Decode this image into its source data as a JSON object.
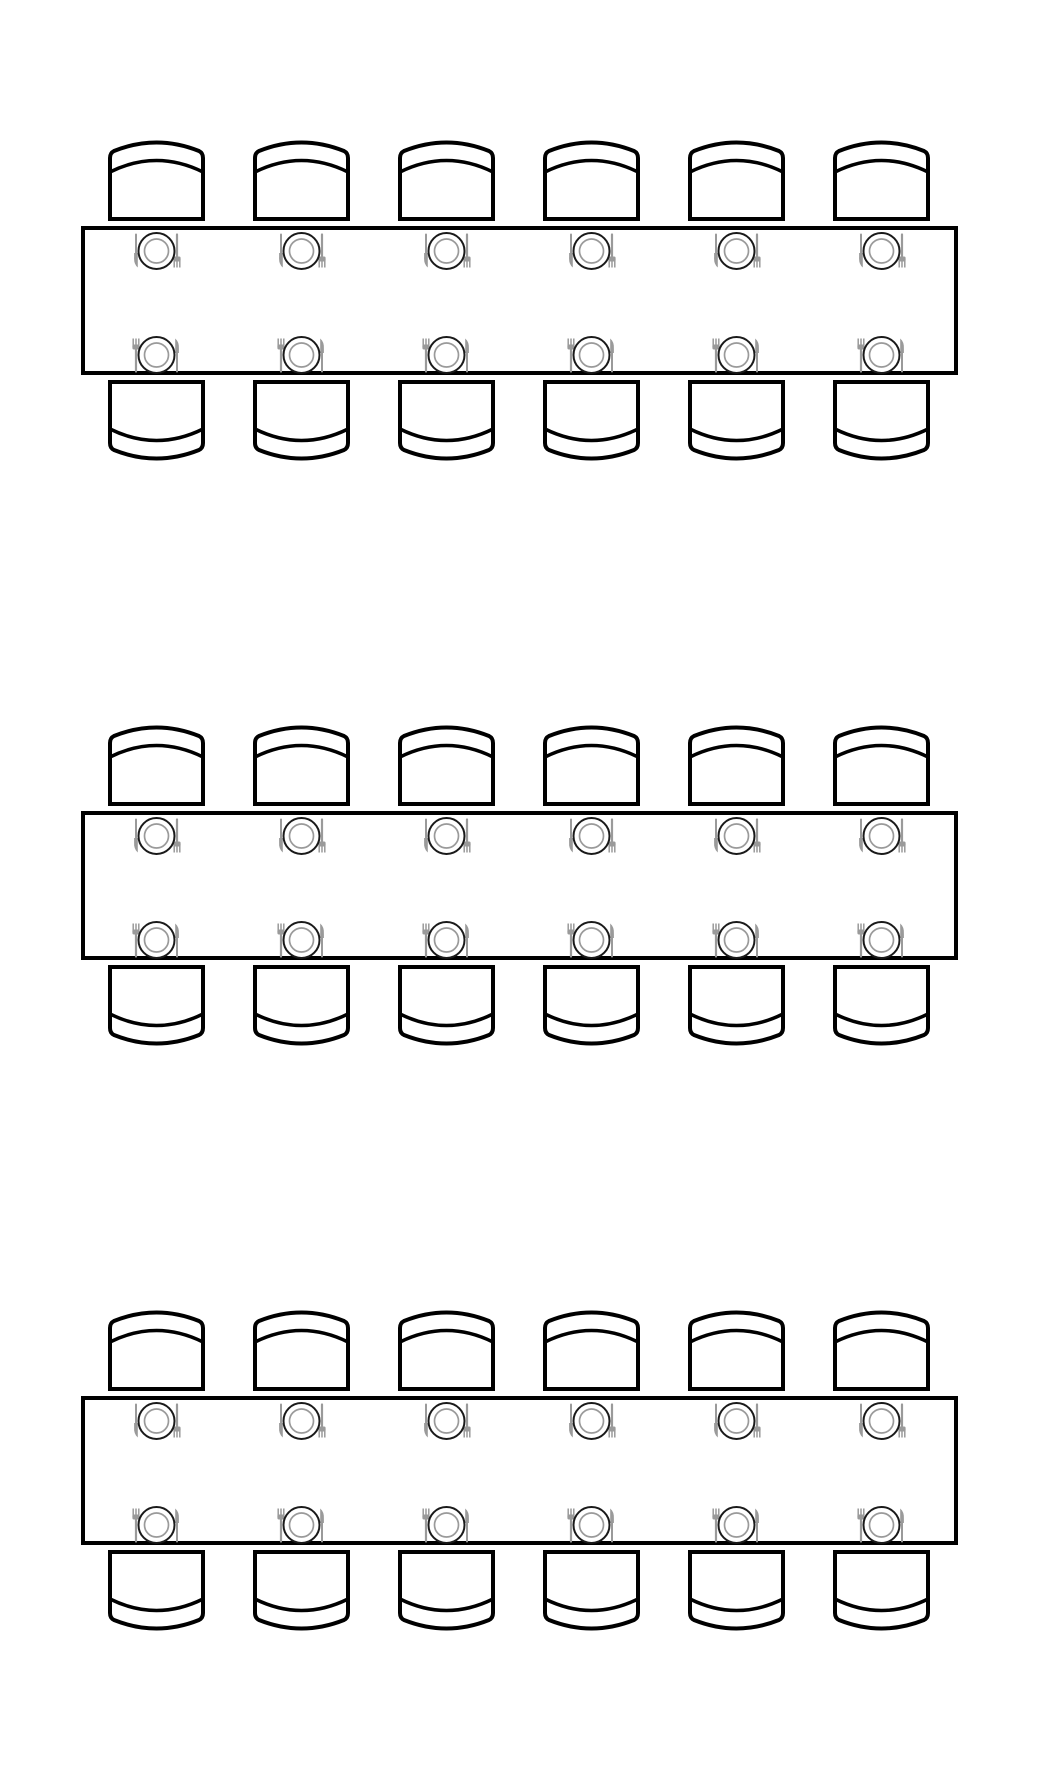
{
  "diagram": {
    "type": "seating-plan",
    "title": "",
    "background_color": "#ffffff",
    "outline_color": "#000000",
    "table_fill_color": "#ffffff",
    "plate_outer_color": "#1a1a1a",
    "plate_inner_color": "#9a9a9a",
    "cutlery_color": "#9a9a9a",
    "canvas": {
      "width": 1040,
      "height": 1773
    },
    "table_geometry": {
      "x": 83,
      "width": 873,
      "height": 145,
      "stroke_width": 4
    },
    "chair_geometry": {
      "width": 97,
      "height": 80,
      "gap_to_table": 7,
      "stroke_width": 4,
      "inner_arc_stroke_width": 3.5
    },
    "seat_columns_x": [
      108,
      253,
      398,
      543,
      688,
      833
    ],
    "place_setting": {
      "items": [
        "fork",
        "plate",
        "knife"
      ],
      "plate_outer_radius": 18,
      "plate_inner_radius": 12,
      "utensil_offset_x": 20.5,
      "top_row_center_offset": 23,
      "bottom_row_center_offset": 18
    },
    "tables": [
      {
        "id": "table-1",
        "top": 228,
        "seats_top": 6,
        "seats_bottom": 6,
        "seat_count": 12
      },
      {
        "id": "table-2",
        "top": 813,
        "seats_top": 6,
        "seats_bottom": 6,
        "seat_count": 12
      },
      {
        "id": "table-3",
        "top": 1398,
        "seats_top": 6,
        "seats_bottom": 6,
        "seat_count": 12
      }
    ],
    "total_tables": 3,
    "total_seats": 36
  }
}
